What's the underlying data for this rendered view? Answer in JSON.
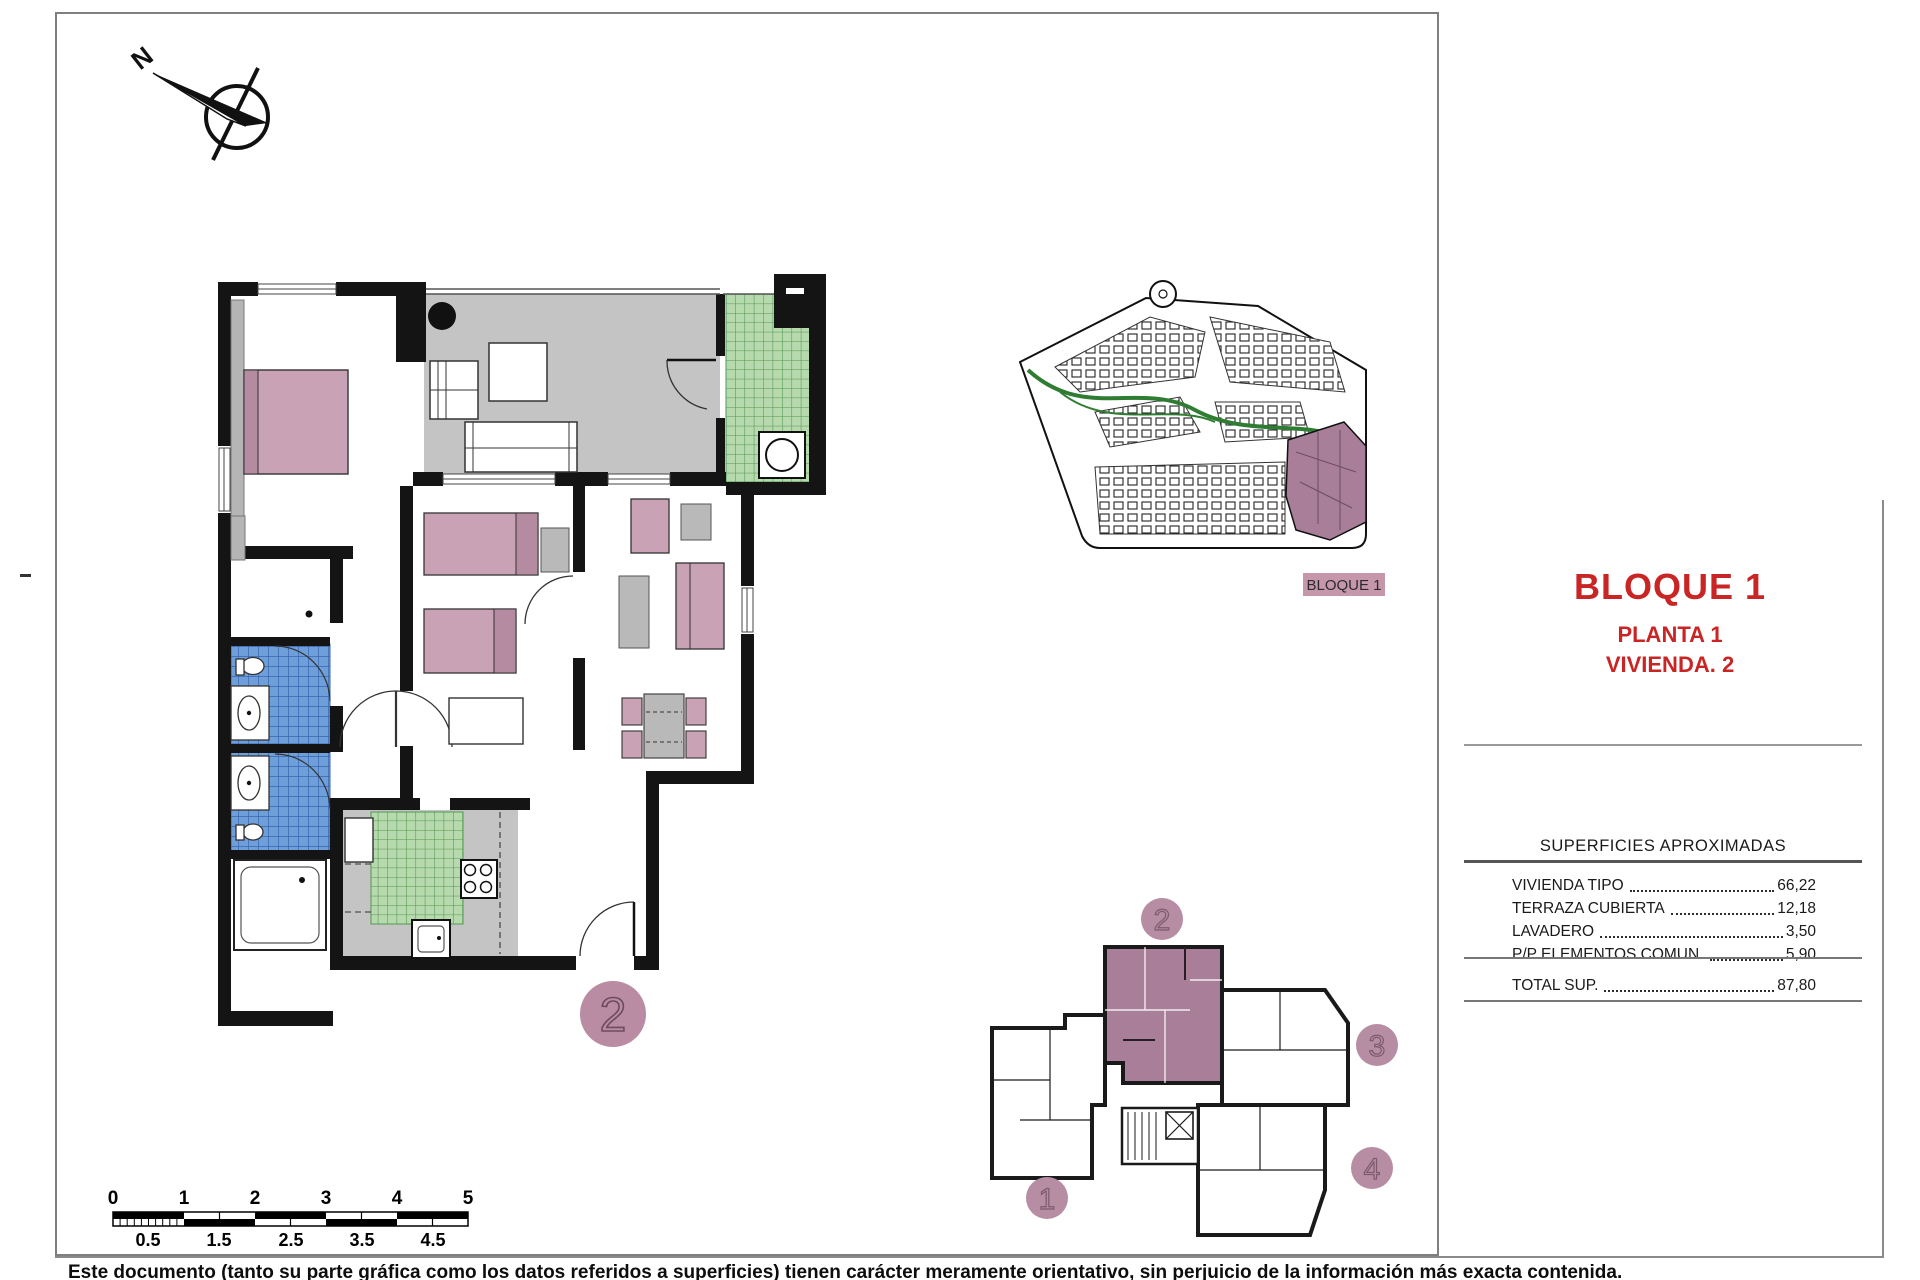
{
  "compass": {
    "label": "N"
  },
  "floor_plan": {
    "unit_badge": "2"
  },
  "site_plan": {
    "block_label": "BLOQUE 1"
  },
  "title_block": {
    "block_title": "BLOQUE 1",
    "floor_line": "PLANTA 1",
    "unit_line": "VIVIENDA. 2"
  },
  "surfaces": {
    "heading": "SUPERFICIES APROXIMADAS",
    "rows": [
      {
        "label": "VIVIENDA TIPO",
        "value": "66,22"
      },
      {
        "label": "TERRAZA CUBIERTA",
        "value": "12,18"
      },
      {
        "label": "LAVADERO",
        "value": "3,50"
      },
      {
        "label": "P/P ELEMENTOS COMUN.",
        "value": "5,90"
      }
    ],
    "total": {
      "label": "TOTAL SUP.",
      "value": "87,80"
    }
  },
  "key_plan": {
    "units": [
      "1",
      "2",
      "3",
      "4"
    ],
    "highlighted_unit": "2"
  },
  "scale_bar": {
    "major_labels": [
      "0",
      "1",
      "2",
      "3",
      "4",
      "5"
    ],
    "minor_labels": [
      "0.5",
      "1.5",
      "2.5",
      "3.5",
      "4.5"
    ]
  },
  "footer": {
    "disclaimer": "Este documento (tanto su parte gráfica como los datos referidos a superficies) tienen carácter meramente orientativo, sin perjuicio de la información más exacta contenida."
  },
  "colors": {
    "accent_red": "#c92525",
    "mauve_fill": "#c9a2b6",
    "mauve_badge": "#b98ca3",
    "highlight_block": "#a87e99",
    "tile_blue": "#6f9fd8",
    "tile_green": "#b7d9ae",
    "floor_gray": "#c4c4c4",
    "wall_black": "#141414"
  }
}
